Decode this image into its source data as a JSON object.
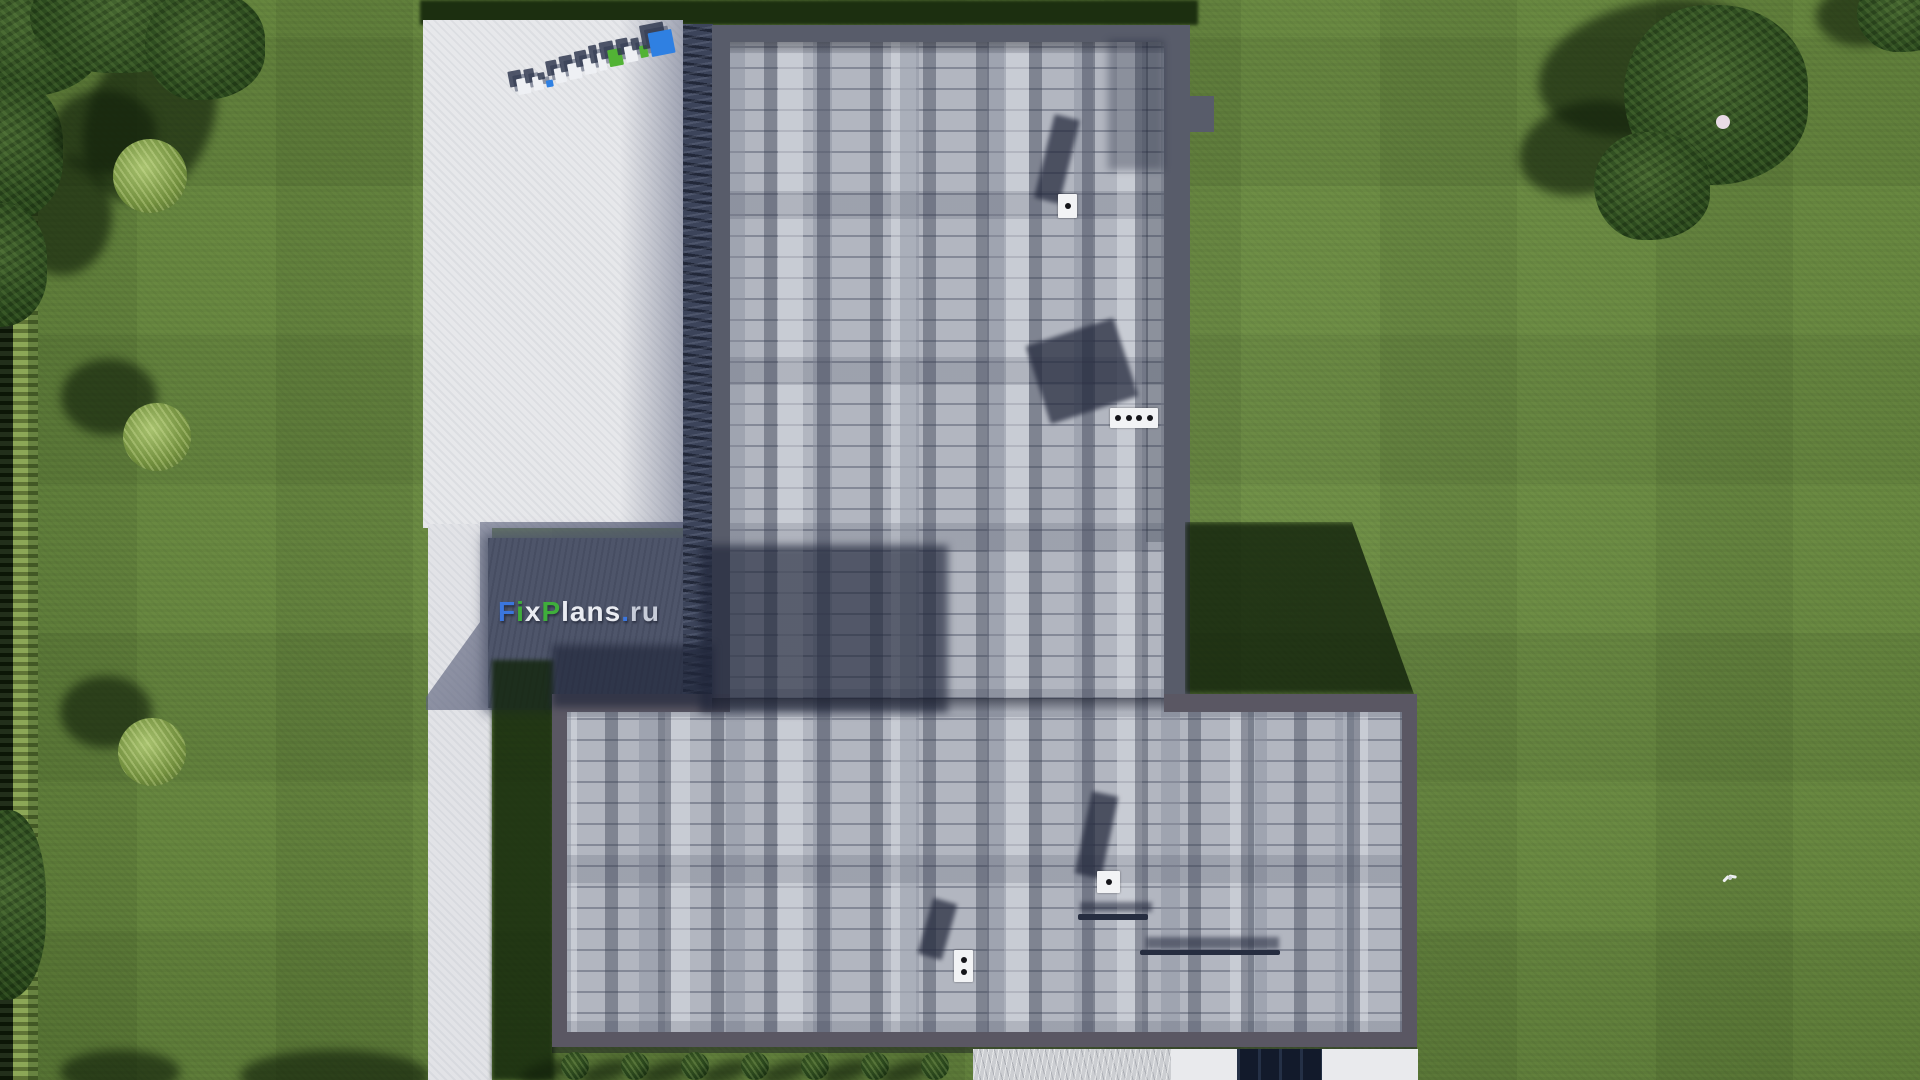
{
  "meta": {
    "description": "Aerial top-down 3D render of a T-shaped house roof with gray shingles, white driveway, lawn, hedges and trees",
    "branding": "FixPlans.ru"
  },
  "watermark": {
    "text": "FixPlans.ru",
    "segments": [
      {
        "text": "F",
        "color": "#3b76dd"
      },
      {
        "text": "i",
        "color": "#3fae3b"
      },
      {
        "text": "x",
        "color": "#e9ebf1"
      },
      {
        "text": "P",
        "color": "#3fae3b"
      },
      {
        "text": "lans",
        "color": "#e9ebf1"
      },
      {
        "text": ".",
        "color": "#3b76dd"
      },
      {
        "text": "ru",
        "color": "#c7ccd8"
      }
    ]
  },
  "logo3d": {
    "description": "extruded FixPlans.ru letters standing on the driveway, seen from above (reads reversed)",
    "slabs": [
      {
        "letter": "u",
        "w": 13,
        "h": 16,
        "color": "#eef0f4",
        "raise": 0
      },
      {
        "letter": "r",
        "w": 10,
        "h": 14,
        "color": "#eef0f4",
        "raise": 1
      },
      {
        "letter": "dot",
        "w": 7,
        "h": 7,
        "color": "#2f80e2",
        "raise": 2
      },
      {
        "letter": "s",
        "w": 11,
        "h": 15,
        "color": "#eef0f4",
        "raise": 4
      },
      {
        "letter": "n",
        "w": 13,
        "h": 16,
        "color": "#eef0f4",
        "raise": 5
      },
      {
        "letter": "a",
        "w": 12,
        "h": 16,
        "color": "#eef0f4",
        "raise": 7
      },
      {
        "letter": "l",
        "w": 8,
        "h": 18,
        "color": "#eef0f4",
        "raise": 8
      },
      {
        "letter": "P",
        "w": 14,
        "h": 17,
        "color": "#52b335",
        "raise": 10
      },
      {
        "letter": "x",
        "w": 12,
        "h": 16,
        "color": "#eef0f4",
        "raise": 11
      },
      {
        "letter": "i",
        "w": 8,
        "h": 12,
        "color": "#52b335",
        "raise": 13
      },
      {
        "letter": "F",
        "w": 24,
        "h": 24,
        "color": "#2f80e2",
        "raise": 12
      }
    ]
  },
  "roof": {
    "vents": [
      {
        "kind": "square-vent",
        "x": 1058,
        "y": 194,
        "w": 19,
        "h": 24,
        "dots": 1,
        "vertical": true,
        "shadow": {
          "x": 1044,
          "y": 116,
          "w": 26,
          "h": 86,
          "rot": 14
        }
      },
      {
        "kind": "slot-vent",
        "x": 1110,
        "y": 408,
        "w": 48,
        "h": 20,
        "dots": 4,
        "vertical": false,
        "shadow": {
          "x": 1036,
          "y": 330,
          "w": 92,
          "h": 82,
          "rot": -18
        }
      },
      {
        "kind": "square-vent",
        "x": 1097,
        "y": 871,
        "w": 23,
        "h": 22,
        "dots": 1,
        "vertical": true,
        "shadow": {
          "x": 1083,
          "y": 793,
          "w": 27,
          "h": 84,
          "rot": 12
        }
      },
      {
        "kind": "double-vent",
        "x": 954,
        "y": 950,
        "w": 19,
        "h": 32,
        "dots": 2,
        "vertical": true,
        "shadow": {
          "x": 925,
          "y": 900,
          "w": 25,
          "h": 58,
          "rot": 16
        }
      }
    ],
    "bars": [
      {
        "x": 1078,
        "y": 914,
        "w": 70,
        "h": 6,
        "shadow": {
          "x": 1080,
          "y": 902,
          "w": 72,
          "h": 10
        }
      },
      {
        "x": 1140,
        "y": 950,
        "w": 140,
        "h": 5,
        "shadow": {
          "x": 1146,
          "y": 937,
          "w": 133,
          "h": 12
        }
      }
    ]
  },
  "landscape": {
    "left_bushes": [
      {
        "cx": 150,
        "cy": 176,
        "r": 37,
        "shadow": {
          "dx": -46,
          "dy": -44,
          "rx": 52,
          "ry": 42
        }
      },
      {
        "cx": 157,
        "cy": 437,
        "r": 34,
        "shadow": {
          "dx": -48,
          "dy": -40,
          "rx": 48,
          "ry": 38
        }
      },
      {
        "cx": 152,
        "cy": 752,
        "r": 34,
        "shadow": {
          "dx": -46,
          "dy": -40,
          "rx": 46,
          "ry": 36
        }
      }
    ],
    "bottom_bushes": [
      {
        "cx": 575,
        "cy": 1066
      },
      {
        "cx": 635,
        "cy": 1066
      },
      {
        "cx": 695,
        "cy": 1066
      },
      {
        "cx": 755,
        "cy": 1066
      },
      {
        "cx": 815,
        "cy": 1066
      },
      {
        "cx": 875,
        "cy": 1066
      },
      {
        "cx": 935,
        "cy": 1066
      }
    ],
    "bottom_bush_r": 14,
    "trees_topleft": {
      "canopies": [
        {
          "cx": 25,
          "cy": 35,
          "rx": 78,
          "ry": 62
        },
        {
          "cx": 125,
          "cy": 18,
          "rx": 95,
          "ry": 55
        },
        {
          "cx": 205,
          "cy": 45,
          "rx": 60,
          "ry": 55
        },
        {
          "cx": 8,
          "cy": 150,
          "rx": 55,
          "ry": 72
        },
        {
          "cx": 2,
          "cy": 265,
          "rx": 45,
          "ry": 62
        },
        {
          "cx": 8,
          "cy": 905,
          "rx": 38,
          "ry": 95
        }
      ],
      "shadows": [
        {
          "cx": 150,
          "cy": 118,
          "rx": 62,
          "ry": 88,
          "rot": 24
        },
        {
          "cx": 62,
          "cy": 215,
          "rx": 50,
          "ry": 60,
          "rot": 0
        },
        {
          "cx": 335,
          "cy": 1076,
          "rx": 95,
          "ry": 26,
          "rot": 0
        },
        {
          "cx": 120,
          "cy": 1072,
          "rx": 60,
          "ry": 22,
          "rot": 0
        }
      ]
    },
    "trees_topright": {
      "canopies": [
        {
          "cx": 1716,
          "cy": 95,
          "rx": 92,
          "ry": 90
        },
        {
          "cx": 1652,
          "cy": 186,
          "rx": 58,
          "ry": 54
        },
        {
          "cx": 1905,
          "cy": 14,
          "rx": 48,
          "ry": 38
        }
      ],
      "shadows": [
        {
          "cx": 1652,
          "cy": 68,
          "rx": 115,
          "ry": 66,
          "rot": -12
        },
        {
          "cx": 1586,
          "cy": 148,
          "rx": 68,
          "ry": 46,
          "rot": -15
        },
        {
          "cx": 1862,
          "cy": 16,
          "rx": 46,
          "ry": 30,
          "rot": 0
        }
      ],
      "flower": {
        "cx": 1723,
        "cy": 122,
        "r": 7
      }
    },
    "bird": {
      "cx": 1729,
      "cy": 877
    }
  },
  "colors": {
    "grass": "#68893f",
    "grass_shadow": "#16300c",
    "driveway": "#e7e8eb",
    "shadow_zone": "#4e556a",
    "mulch_band": "#3c445a",
    "fascia_upper": "#585c6a",
    "fascia_lower": "#5a5763",
    "shingle_base": "#b2b6c0",
    "vent_white": "#f2f3f5",
    "window_dark": "#121a2b",
    "gravel": "#ccced2"
  }
}
